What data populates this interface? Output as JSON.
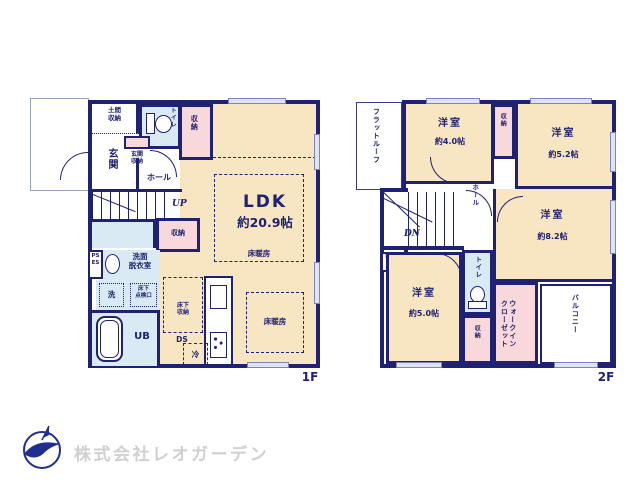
{
  "colors": {
    "wall": "#1f2173",
    "room_cream": "#f7e6c1",
    "storage_pink": "#f8d8da",
    "wet_blue": "#daeaf4",
    "window": "#dfe3f5",
    "logo_navy": "#1f2f8f",
    "logo_text_gray": "#d0d0d0"
  },
  "floor1": {
    "label": "1F",
    "rooms": {
      "doma": "土間\n収納",
      "toilet": "トイレ",
      "closet_top": "収納",
      "genkan": "玄関",
      "genkan_closet": "玄関\n収納",
      "hall": "ホール",
      "up": "UP",
      "closet_mid": "収納",
      "ps_es": "PS\nES",
      "senmen": "洗面\n脱衣室",
      "laundry": "洗",
      "tenkenko": "床下\n点検口",
      "ub": "UB",
      "yukashita": "床下\n収納",
      "ds": "DS",
      "rei": "冷",
      "ldk_name": "LDK",
      "ldk_size": "約20.9帖",
      "yukadanbo": "床暖房"
    }
  },
  "floor2": {
    "label": "2F",
    "rooms": {
      "flat_roof": "フラットルーフ",
      "room40_name": "洋室",
      "room40_size": "約4.0帖",
      "closet_top": "収納",
      "room52_name": "洋室",
      "room52_size": "約5.2帖",
      "hall": "ホール",
      "dn": "DN",
      "ds": "D\nS",
      "room82_name": "洋室",
      "room82_size": "約8.2帖",
      "room50_name": "洋室",
      "room50_size": "約5.0帖",
      "toilet": "トイレ",
      "closet_bottom": "収納",
      "wic": "ウォークイン\nクローゼット",
      "balcony": "バルコニー"
    }
  },
  "footer": {
    "company": "株式会社レオガーデン"
  }
}
